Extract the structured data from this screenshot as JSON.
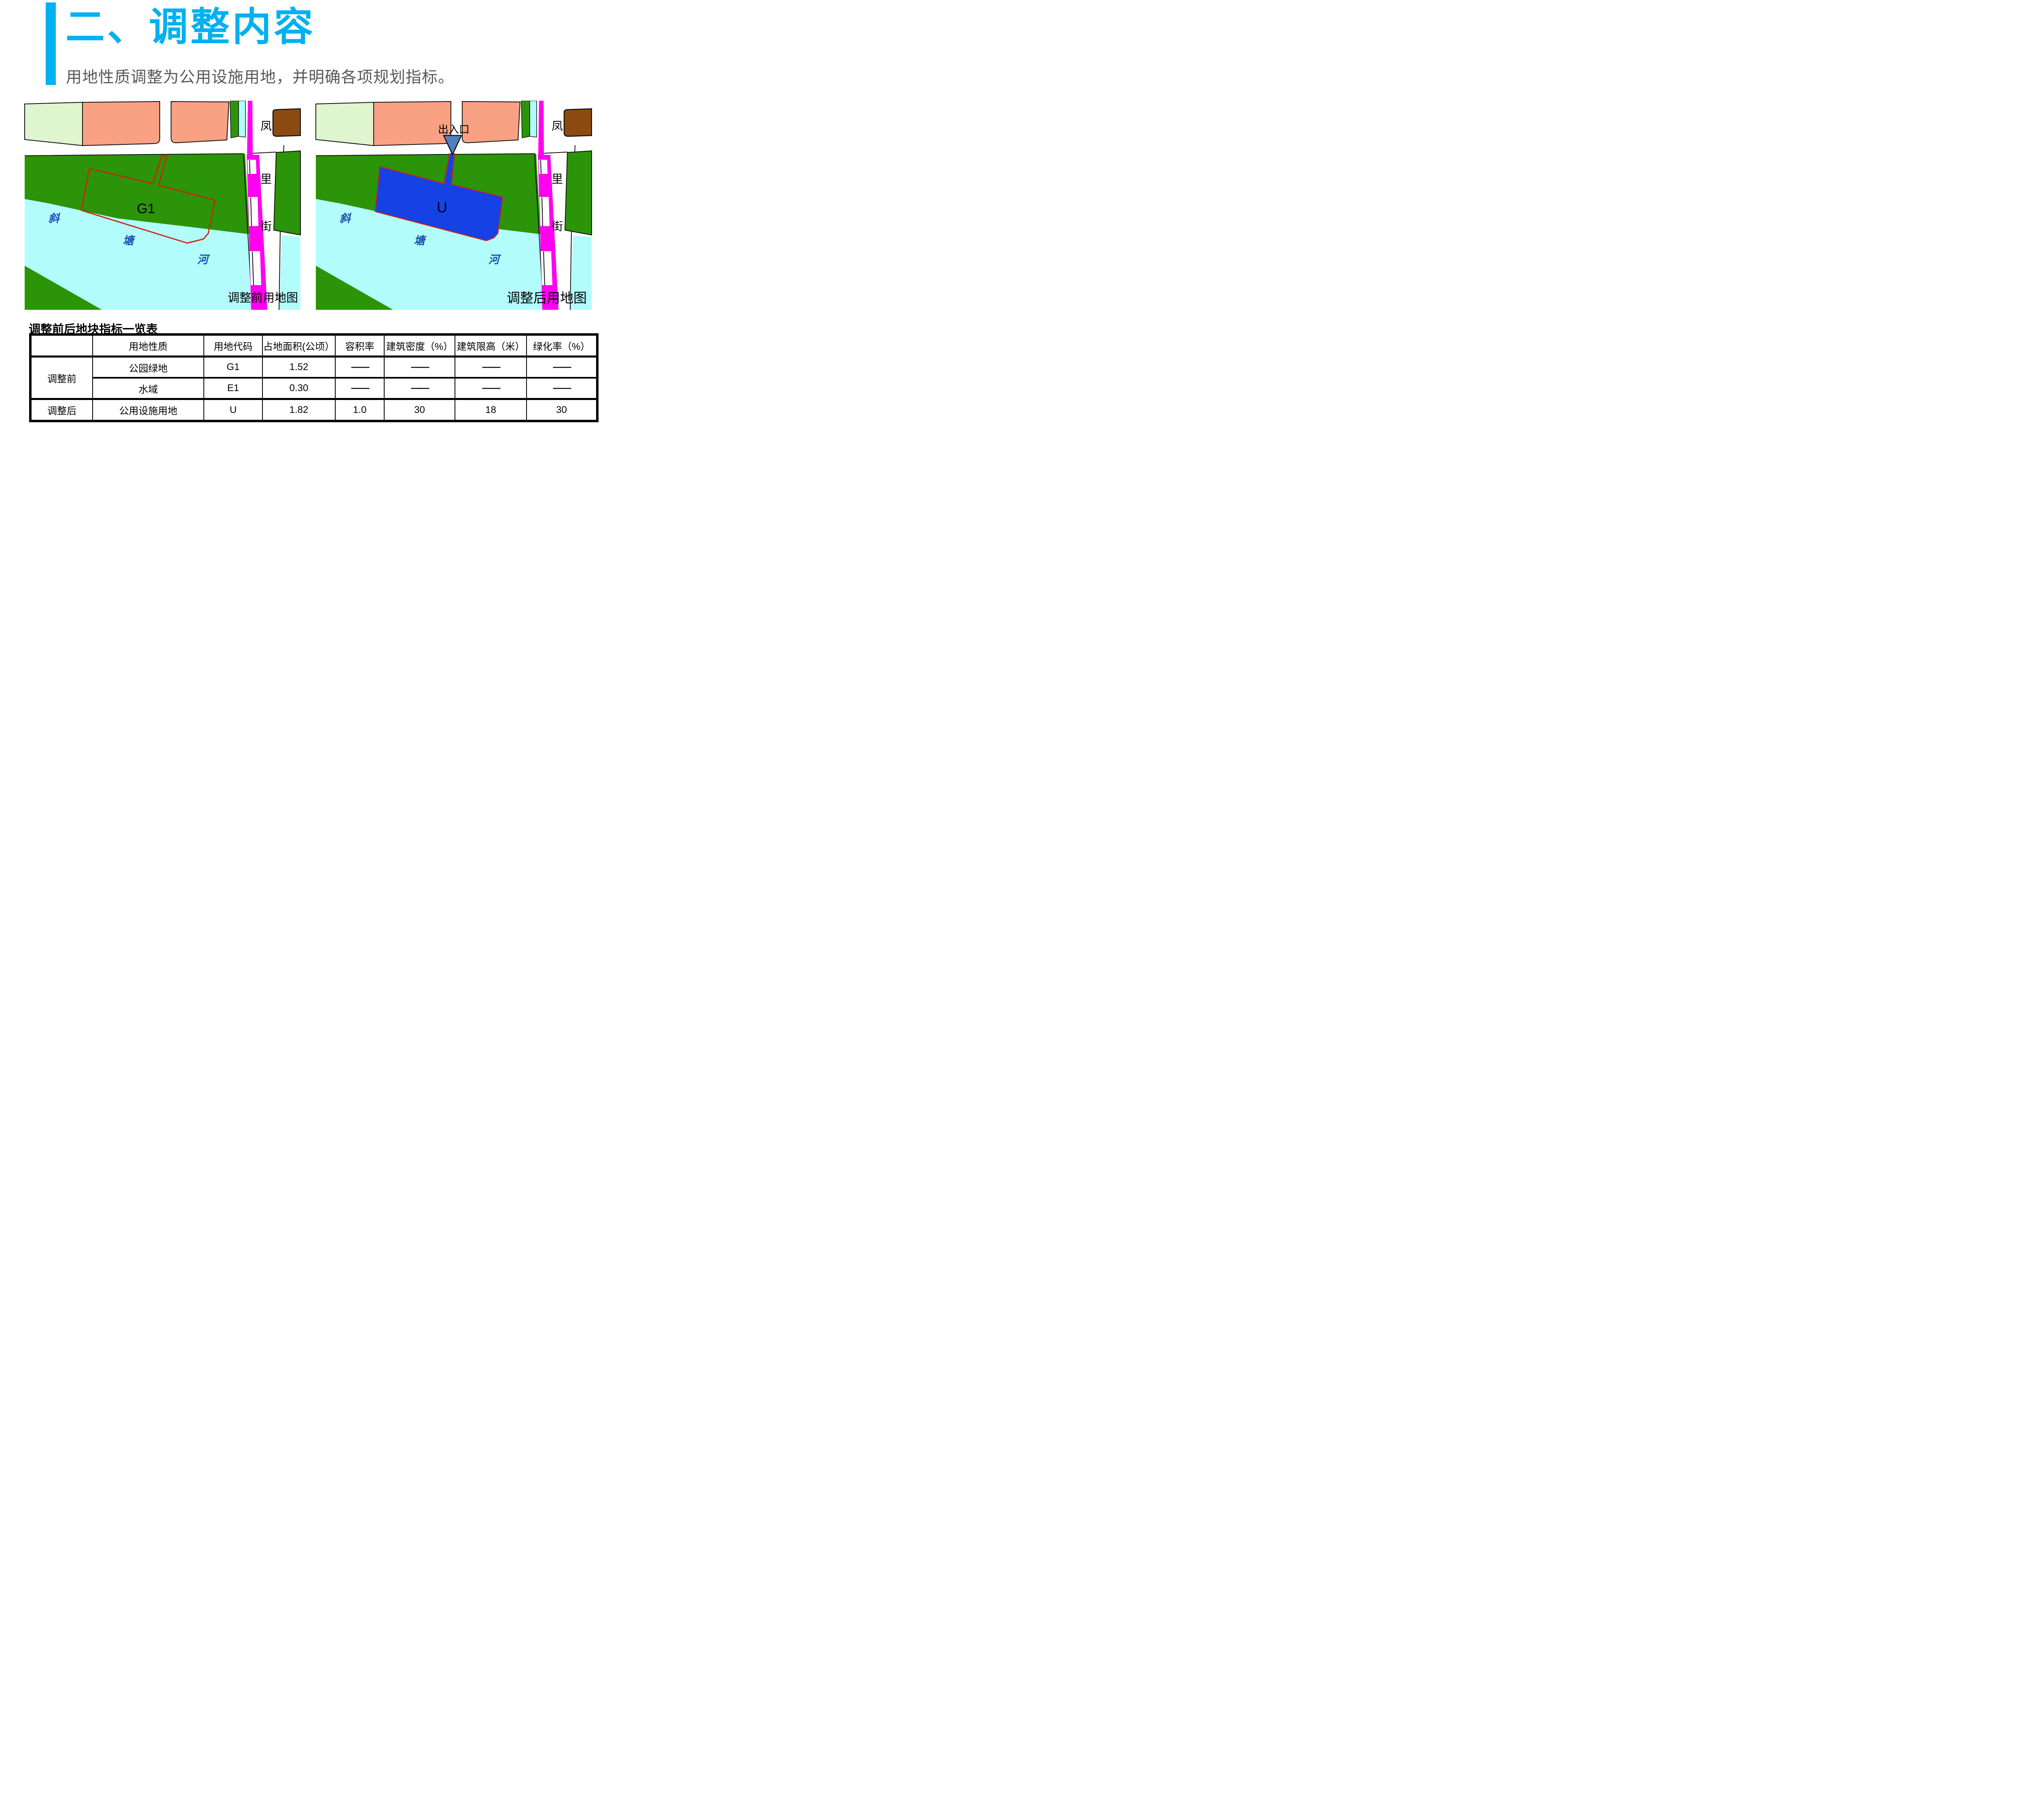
{
  "page": {
    "title": "二、调整内容",
    "subtitle": "用地性质调整为公用设施用地，并明确各项规划指标。"
  },
  "maps": {
    "street_chars": [
      "凤",
      "里",
      "街"
    ],
    "river_chars": [
      "斜",
      "塘",
      "河"
    ],
    "before": {
      "caption": "调整前用地图",
      "plot_label": "G1"
    },
    "after": {
      "caption": "调整后用地图",
      "plot_label": "U",
      "entrance_label": "出入口"
    }
  },
  "table": {
    "title": "调整前后地块指标一览表",
    "headers": [
      "",
      "用地性质",
      "用地代码",
      "占地面积(公顷）",
      "容积率",
      "建筑密度（%）",
      "建筑限高（米）",
      "绿化率（%）"
    ],
    "rows": [
      {
        "group": "调整前",
        "cells": [
          "公园绿地",
          "G1",
          "1.52",
          "——",
          "——",
          "——",
          "——"
        ]
      },
      {
        "group": "",
        "cells": [
          "水域",
          "E1",
          "0.30",
          "——",
          "——",
          "——",
          "——"
        ]
      },
      {
        "group": "调整后",
        "cells": [
          "公用设施用地",
          "U",
          "1.82",
          "1.0",
          "30",
          "18",
          "30"
        ]
      }
    ]
  },
  "colors": {
    "accent_blue": "#00B0F0",
    "subtitle_gray": "#595959",
    "highlight_red": "#FF0000",
    "park_green": "#2B9408",
    "pale_green": "#DFF5CF",
    "residential_salmon": "#F9A183",
    "river_cyan": "#B2FCFC",
    "road_magenta": "#FF00F0",
    "utility_blue": "#1641E4",
    "parcel_brown": "#8C4B10",
    "boundary_red": "#CF2213",
    "river_text_blue": "#1B4AB4",
    "entrance_marker_blue": "#5080BE"
  }
}
